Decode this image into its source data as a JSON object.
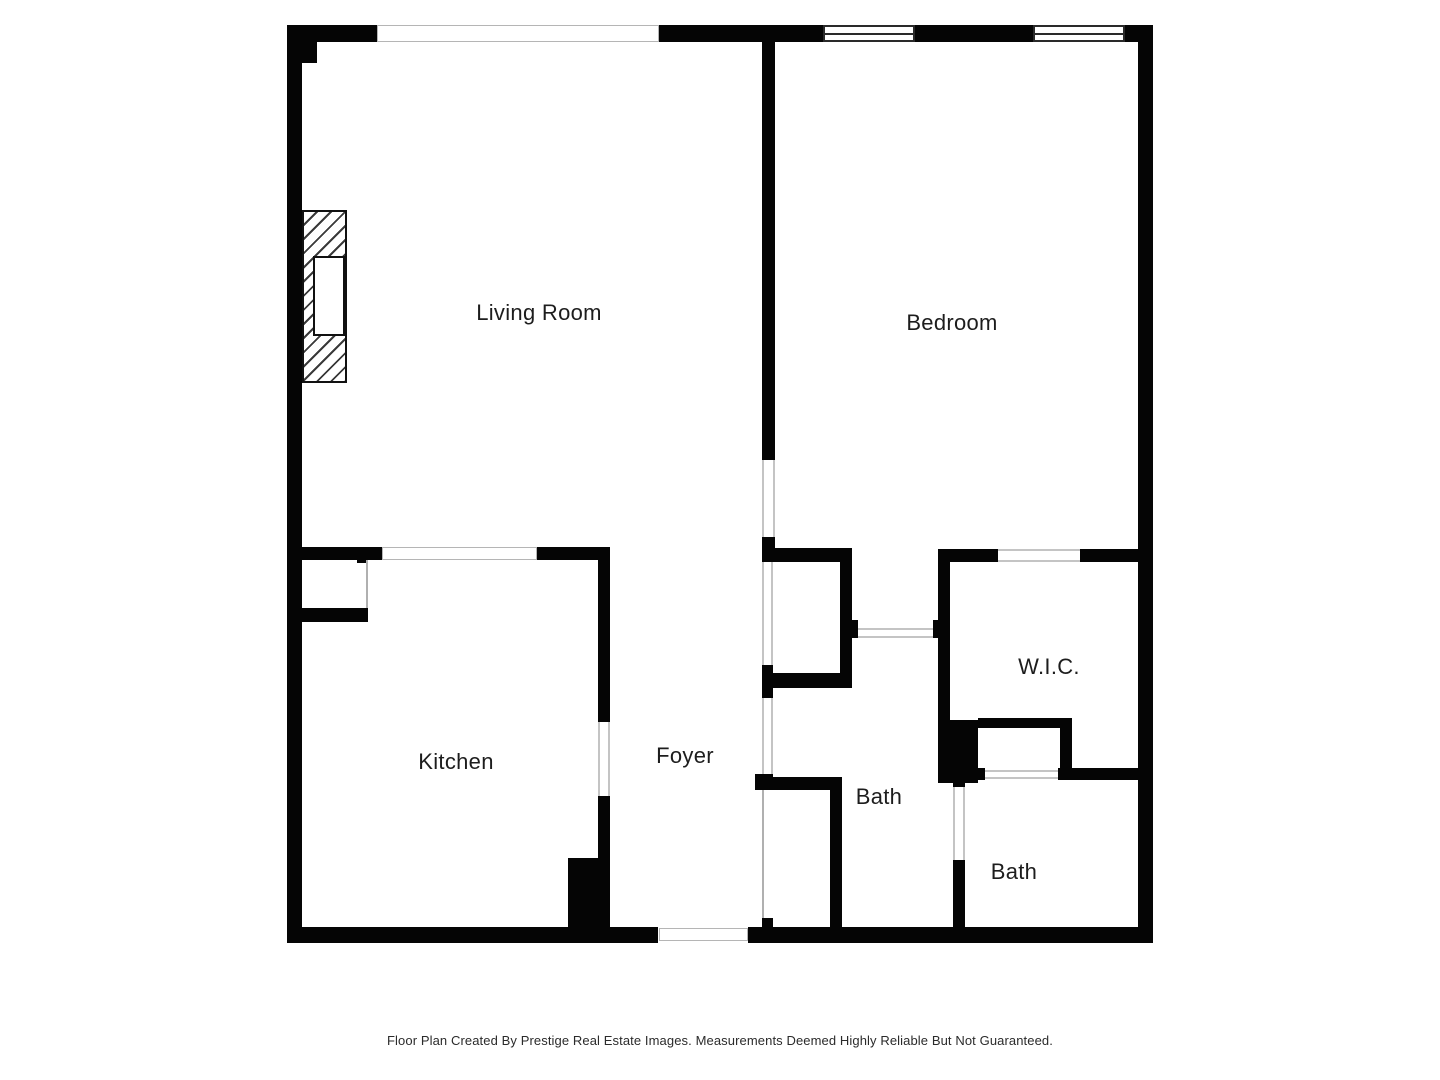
{
  "plan": {
    "rooms": {
      "living_room": {
        "label": "Living Room"
      },
      "bedroom": {
        "label": "Bedroom"
      },
      "kitchen": {
        "label": "Kitchen"
      },
      "foyer": {
        "label": "Foyer"
      },
      "bath_1": {
        "label": "Bath"
      },
      "wic": {
        "label": "W.I.C."
      },
      "bath_2": {
        "label": "Bath"
      }
    },
    "symbols": {
      "fireplace": "fireplace-symbol",
      "window": "window-symbol",
      "door_opening": "door-opening",
      "entry_opening": "entry-door-opening"
    }
  },
  "footer": {
    "text": "Floor Plan Created By Prestige Real Estate Images. Measurements Deemed Highly Reliable But Not Guaranteed."
  },
  "colors": {
    "wall": "#050505",
    "background": "#ffffff",
    "label_text": "#1d1d1d",
    "opening_line": "#c4c4c4"
  }
}
